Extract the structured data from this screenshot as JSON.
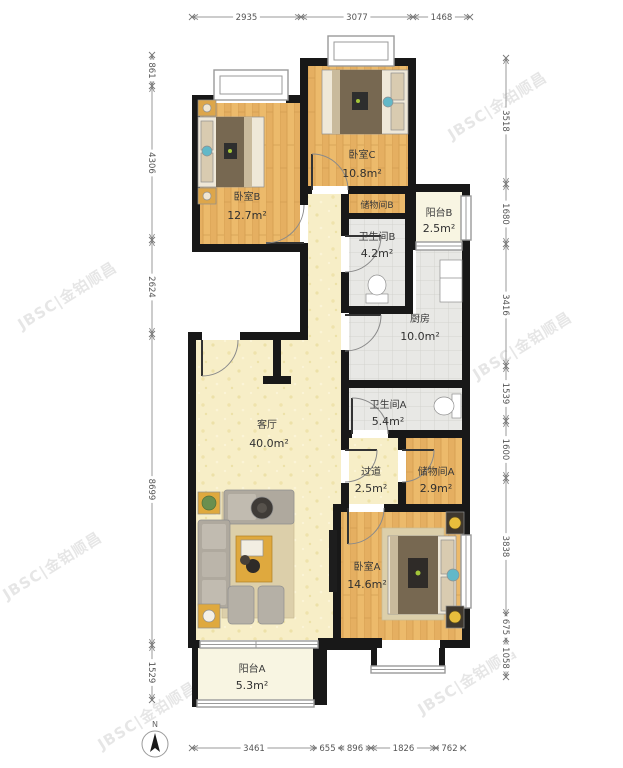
{
  "watermark": {
    "text": "JBSC|金铂顺昌",
    "color": "#c6c6c6"
  },
  "compass": {
    "label": "N"
  },
  "rooms": {
    "bedroomB": {
      "name": "卧室B",
      "area": "12.7m²"
    },
    "bedroomC": {
      "name": "卧室C",
      "area": "10.8m²"
    },
    "storageB": {
      "name": "储物间B",
      "area": ""
    },
    "bathroomB": {
      "name": "卫生间B",
      "area": "4.2m²"
    },
    "balconyB": {
      "name": "阳台B",
      "area": "2.5m²"
    },
    "kitchen": {
      "name": "厨房",
      "area": "10.0m²"
    },
    "bathroomA": {
      "name": "卫生间A",
      "area": "5.4m²"
    },
    "living": {
      "name": "客厅",
      "area": "40.0m²"
    },
    "hallway": {
      "name": "过道",
      "area": "2.5m²"
    },
    "storageA": {
      "name": "储物间A",
      "area": "2.9m²"
    },
    "bedroomA": {
      "name": "卧室A",
      "area": "14.6m²"
    },
    "balconyA": {
      "name": "阳台A",
      "area": "5.3m²"
    }
  },
  "dimensions": {
    "top": [
      "2935",
      "3077",
      "1468"
    ],
    "bottom": [
      "3461",
      "655",
      "896",
      "1826",
      "762"
    ],
    "left": [
      "861",
      "4306",
      "2624",
      "8699",
      "1529"
    ],
    "right": [
      "3518",
      "1680",
      "3416",
      "1539",
      "1600",
      "3838",
      "675",
      "1058"
    ]
  }
}
